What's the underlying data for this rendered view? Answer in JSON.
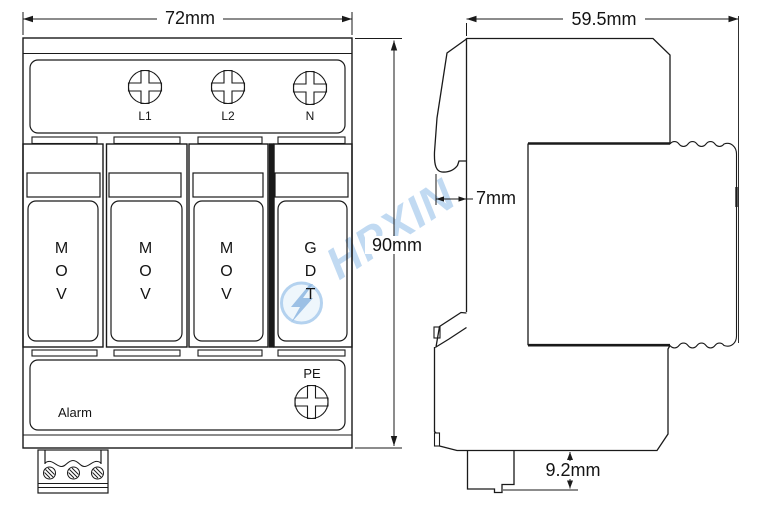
{
  "drawing": {
    "front_view": {
      "width_dim": "72mm",
      "height_dim": "90mm",
      "terminal_labels": [
        "L1",
        "L2",
        "N"
      ],
      "modules": [
        {
          "label": "MOV"
        },
        {
          "label": "MOV"
        },
        {
          "label": "MOV"
        },
        {
          "label": "GDT"
        }
      ],
      "pe_label": "PE",
      "alarm_label": "Alarm"
    },
    "side_view": {
      "depth_dim": "59.5mm",
      "din_clip_dim": "7mm",
      "terminal_depth_dim": "9.2mm"
    },
    "watermark": {
      "text": "HPXIN"
    },
    "colors": {
      "line": "#1a1a1a",
      "watermark_blue": "#8ebce8",
      "background": "#ffffff"
    }
  }
}
